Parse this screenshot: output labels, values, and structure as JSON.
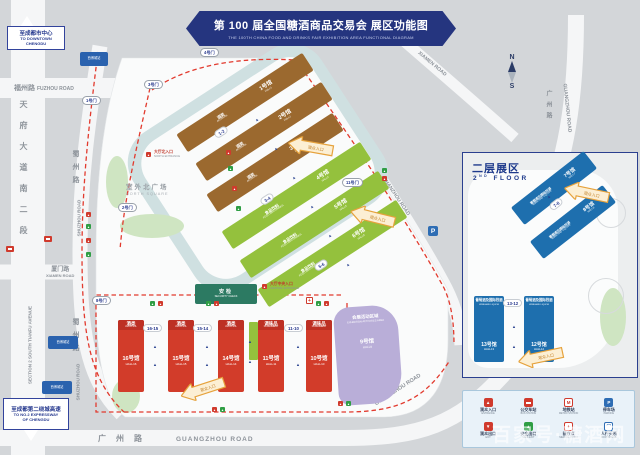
{
  "banner": {
    "title": "第 100 届全国糖酒商品交易会  展区功能图",
    "subtitle": "THE 100TH CHINA FOOD AND DRINKS FAIR  EXHIBITION AREA FUNCTIONAL DIAGRAM"
  },
  "signs": {
    "downtown": {
      "cn": "至成都市中心",
      "en1": "TO DOWNTOWN",
      "en2": "CHENGDU"
    },
    "expressway": {
      "cn": "至成都第二绕城高速",
      "en1": "TO NO.2 EXPRESSWAY",
      "en2": "OF CHENGDU"
    }
  },
  "roads": {
    "fuzhou_cn": "福州路",
    "fuzhou_en": "FUZHOU ROAD",
    "tianfu_cn": "天府大道南二段",
    "tianfu_en": "SECTION 2 SOUTH TIANFU AVENUE",
    "shuzhou_cn": "蜀州路",
    "shuzhou_en": "SHUZHOU ROAD",
    "xiamen_cn": "厦门路",
    "xiamen_en": "XIAMEN ROAD",
    "hanzhou_cn1": "汉",
    "hanzhou_cn2": "州",
    "hanzhou_en": "HANZHOU ROAD",
    "guangzhou_cn": "广州路",
    "guangzhou_en": "GUANGZHOU ROAD"
  },
  "compass": {
    "n": "N",
    "s": "S"
  },
  "north_halls": [
    {
      "no": "1号馆",
      "en": "HALL1",
      "cat": "酒类",
      "cat_en": "ALCOHOL"
    },
    {
      "no": "2号馆",
      "en": "HALL2",
      "cat": "酒类",
      "cat_en": "ALCOHOL"
    },
    {
      "no": "3号馆",
      "en": "HALL3",
      "cat": "酒类",
      "cat_en": "ALCOHOL"
    },
    {
      "no": "4号馆",
      "en": "HALL4",
      "cat": "食品饮料",
      "cat_en": "FOOD AND DRINKS"
    },
    {
      "no": "5号馆",
      "en": "HALL5",
      "cat": "食品饮料",
      "cat_en": "FOOD AND DRINKS"
    },
    {
      "no": "6号馆",
      "en": "HALL6",
      "cat": "食品饮料",
      "cat_en": "FOOD AND DRINKS"
    }
  ],
  "north_gates": [
    "1-2",
    "3-4",
    "5-6"
  ],
  "south_halls": [
    {
      "no": "16号馆",
      "en": "HALL16",
      "cat": "酒类",
      "cat_en": "ALCOHOL"
    },
    {
      "no": "15号馆",
      "en": "HALL15",
      "cat": "酒类",
      "cat_en": "ALCOHOL"
    },
    {
      "no": "14号馆",
      "en": "HALL14",
      "cat": "酒类",
      "cat_en": "ALCOHOL"
    },
    {
      "no": "11号馆",
      "en": "HALL11",
      "cat": "调味品",
      "cat_en": "CONDIMENT"
    },
    {
      "no": "10号馆",
      "en": "HALL10",
      "cat": "调味品",
      "cat_en": "CONDIMENT"
    }
  ],
  "south_gates": [
    "16-15",
    "15-14",
    "11-10"
  ],
  "hall9": {
    "area_cn": "会展活动区域",
    "area_en": "EXHIBITION ACTIVITIES AREA",
    "no": "9号馆",
    "en": "HALL9"
  },
  "places": {
    "north_square_cn": "室外北广场",
    "north_square_en": "NORTH SQUARE",
    "security_cn": "安检",
    "security_en": "SECURITY CHECK",
    "central_entrance_cn": "大厅中央入口",
    "central_entrance_en": "CENTRAL ENTRANCE",
    "north_entrance_cn": "大厅北入口",
    "north_entrance_en": "NORTH ENTRANCE",
    "metro_sign": "西博城站"
  },
  "gates": [
    "1号门",
    "2号门",
    "3号门",
    "4号门",
    "8号门",
    "11号门"
  ],
  "arrow_label": {
    "cn": "观众入口",
    "en": "ENTRANCE"
  },
  "inset": {
    "title_cn": "二层展区",
    "title_en_num": "2",
    "title_en_sup": "ND",
    "title_en_rest": " FLOOR",
    "halls": [
      {
        "no": "7号馆",
        "en": "HALL7",
        "cat": "葡萄酒及国际烈酒",
        "cat_en": "WINE AND LIQUOR"
      },
      {
        "no": "8号馆",
        "en": "HALL8",
        "cat": "葡萄酒及国际烈酒",
        "cat_en": "WINE AND LIQUOR"
      },
      {
        "no": "13号馆",
        "en": "HALL13",
        "cat": "葡萄酒及国际烈酒",
        "cat_en": "WINE AND LIQUOR"
      },
      {
        "no": "12号馆",
        "en": "HALL12",
        "cat": "葡萄酒及国际烈酒",
        "cat_en": "WINE AND LIQUOR"
      }
    ],
    "gates": [
      "7-8",
      "13-12"
    ]
  },
  "legend": {
    "items": [
      {
        "cn": "观众入口",
        "en": "ENTRANCE"
      },
      {
        "cn": "公交车站",
        "en": "BUS STATION"
      },
      {
        "cn": "地铁站",
        "en": "METRO STATION"
      },
      {
        "cn": "停车场",
        "en": "PARKING"
      },
      {
        "cn": "观众出口",
        "en": "EXIT"
      },
      {
        "cn": "安全出口",
        "en": "SAFE EXIT"
      },
      {
        "cn": "医疗点",
        "en": "MEDICAL POINT"
      },
      {
        "cn": "人行天桥",
        "en": "FOOTBRIDGE"
      }
    ]
  },
  "watermark": "百家号·糖酒网"
}
